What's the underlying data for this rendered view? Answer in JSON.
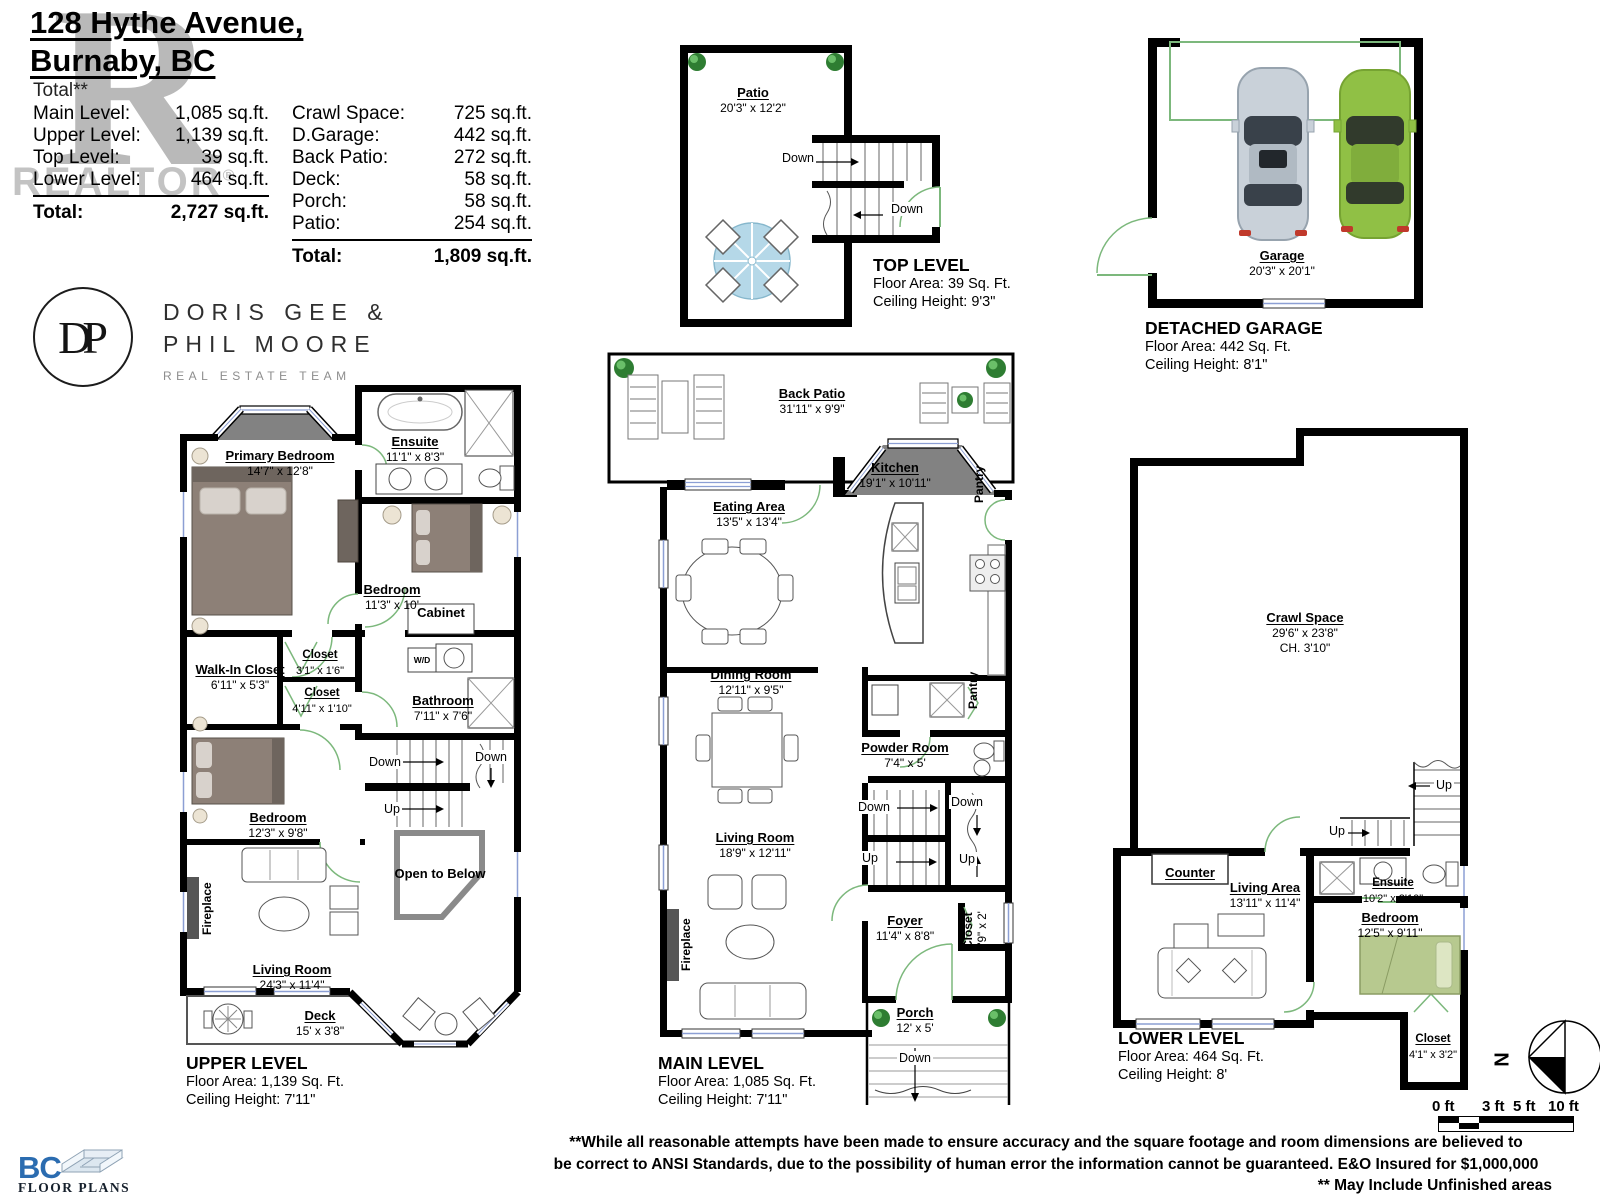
{
  "header": {
    "address_line1": "128 Hythe Avenue,",
    "address_line2": "Burnaby, BC",
    "total_note": "Total**",
    "levels": [
      {
        "label": "Main Level:",
        "value": "1,085 sq.ft."
      },
      {
        "label": "Upper Level:",
        "value": "1,139 sq.ft."
      },
      {
        "label": "Top Level:",
        "value": "39 sq.ft."
      },
      {
        "label": "Lower Level:",
        "value": "464 sq.ft."
      }
    ],
    "levels_total_label": "Total:",
    "levels_total_value": "2,727 sq.ft.",
    "areas": [
      {
        "label": "Crawl Space:",
        "value": "725 sq.ft."
      },
      {
        "label": "D.Garage:",
        "value": "442 sq.ft."
      },
      {
        "label": "Back Patio:",
        "value": "272 sq.ft."
      },
      {
        "label": "Deck:",
        "value": "58 sq.ft."
      },
      {
        "label": "Porch:",
        "value": "58 sq.ft."
      },
      {
        "label": "Patio:",
        "value": "254 sq.ft."
      }
    ],
    "areas_total_label": "Total:",
    "areas_total_value": "1,809 sq.ft.",
    "watermark_letter": "R",
    "watermark_text": "REALTOR",
    "watermark_reg": "®"
  },
  "branding": {
    "monogram": "DP",
    "team_line1": "DORIS GEE &",
    "team_line2": "PHIL MOORE",
    "team_subtitle": "REAL ESTATE TEAM"
  },
  "top_level": {
    "patio_name": "Patio",
    "patio_dims": "20'3\" x 12'2\"",
    "down1": "Down",
    "down2": "Down",
    "caption_title": "TOP LEVEL",
    "caption_area": "Floor Area: 39 Sq. Ft.",
    "caption_ceiling": "Ceiling Height: 9'3\""
  },
  "garage": {
    "room_name": "Garage",
    "room_dims": "20'3\" x 20'1\"",
    "caption_title": "DETACHED GARAGE",
    "caption_area": "Floor Area: 442 Sq. Ft.",
    "caption_ceiling": "Ceiling Height: 8'1\""
  },
  "upper": {
    "primary_bedroom_name": "Primary Bedroom",
    "primary_bedroom_dims": "14'7\" x 12'8\"",
    "ensuite_name": "Ensuite",
    "ensuite_dims": "11'1\" x 8'3\"",
    "bedroom1_name": "Bedroom",
    "bedroom1_dims": "11'3\" x 10'",
    "cabinet": "Cabinet",
    "walkin_name": "Walk-In Closet",
    "walkin_dims": "6'11\" x 5'3\"",
    "closet1_name": "Closet",
    "closet1_dims": "3'1\" x 1'6\"",
    "closet2_name": "Closet",
    "closet2_dims": "4'11\" x 1'10\"",
    "bathroom_name": "Bathroom",
    "bathroom_dims": "7'11\" x 7'6\"",
    "wd": "W/D",
    "bedroom2_name": "Bedroom",
    "bedroom2_dims": "12'3\" x 9'8\"",
    "down1": "Down",
    "down2": "Down",
    "up1": "Up",
    "open_to_below": "Open to Below",
    "fireplace": "Fireplace",
    "living_name": "Living Room",
    "living_dims": "24'3\" x 11'4\"",
    "deck_name": "Deck",
    "deck_dims": "15' x 3'8\"",
    "caption_title": "UPPER LEVEL",
    "caption_area": "Floor Area: 1,139 Sq. Ft.",
    "caption_ceiling": "Ceiling Height: 7'11\""
  },
  "main": {
    "back_patio_name": "Back Patio",
    "back_patio_dims": "31'11\" x 9'9\"",
    "kitchen_name": "Kitchen",
    "kitchen_dims": "19'1\" x 10'11\"",
    "pantry1": "Pantry",
    "pantry2": "Pantry",
    "eating_name": "Eating Area",
    "eating_dims": "13'5\" x 13'4\"",
    "dining_name": "Dining Room",
    "dining_dims": "12'11\" x 9'5\"",
    "powder_name": "Powder Room",
    "powder_dims": "7'4\" x 5'",
    "living_name": "Living Room",
    "living_dims": "18'9\" x 12'11\"",
    "foyer_name": "Foyer",
    "foyer_dims": "11'4\" x 8'8\"",
    "closet_name": "Closet",
    "closet_dims": "5'9\" x 2'",
    "fireplace": "Fireplace",
    "porch_name": "Porch",
    "porch_dims": "12' x 5'",
    "down1": "Down",
    "down2": "Down",
    "up1": "Up",
    "up2": "Up",
    "down3": "Down",
    "caption_title": "MAIN LEVEL",
    "caption_area": "Floor Area: 1,085 Sq. Ft.",
    "caption_ceiling": "Ceiling Height: 7'11\""
  },
  "lower": {
    "crawl_name": "Crawl Space",
    "crawl_dims": "29'6\" x 23'8\"",
    "crawl_ch": "CH. 3'10\"",
    "counter": "Counter",
    "living_name": "Living Area",
    "living_dims": "13'11\" x 11'4\"",
    "ensuite_name": "Ensuite",
    "ensuite_dims": "10'2\" x 2'10\"",
    "bedroom_name": "Bedroom",
    "bedroom_dims": "12'5\" x 9'11\"",
    "closet_name": "Closet",
    "closet_dims": "4'1\" x 3'2\"",
    "up1": "Up",
    "up2": "Up",
    "caption_title": "LOWER LEVEL",
    "caption_area": "Floor Area: 464 Sq. Ft.",
    "caption_ceiling": "Ceiling Height: 8'"
  },
  "footer": {
    "compass_n": "N",
    "scale_labels": [
      "0 ft",
      "3 ft",
      "5 ft",
      "10 ft"
    ],
    "logo_bc": "BC",
    "logo_floor_plans": "FLOOR PLANS",
    "disclaimer_line1": "**While all reasonable attempts have been made to ensure accuracy and the square footage and room dimensions are believed to",
    "disclaimer_line2": "be correct to ANSI Standards, due to the possibility of human error the information cannot be guaranteed. E&O Insured for $1,000,000",
    "disclaimer_line3": "** May Include Unfinished areas"
  },
  "colors": {
    "wall": "#000000",
    "door_green": "#7cb87c",
    "window_blue": "#8c9fd4",
    "bay_gray": "#828282",
    "bed_gray": "#8d8077",
    "bed_green": "#b7c98f",
    "car_silver": "#c9d1d9",
    "car_green": "#90c045",
    "logo_blue": "#2b6cb0",
    "watermark_gray": "#b9b9b9"
  }
}
